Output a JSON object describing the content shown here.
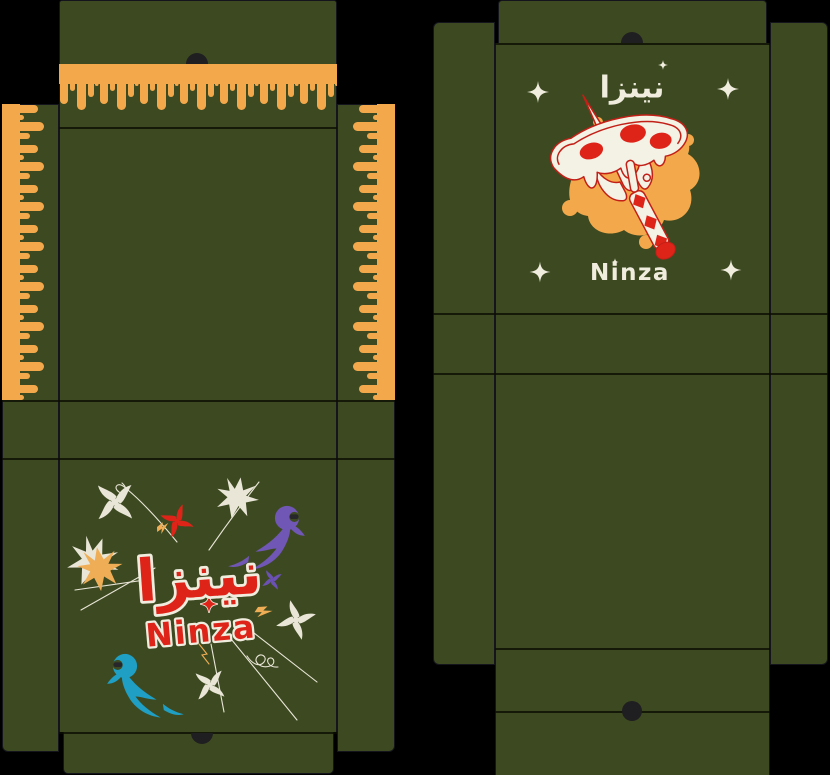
{
  "brand": {
    "arabic": "نينزا",
    "latin": "Ninza"
  },
  "left_dieline": {
    "description": "box base dieline with cheese-drip walls",
    "base_logo": {
      "arabic": "نينزا",
      "latin": "Ninza"
    }
  },
  "right_dieline": {
    "description": "box lid dieline with pizza-sai emblem",
    "lid_logo": {
      "arabic": "نينزا",
      "latin": "Ninza"
    }
  },
  "colors": {
    "bg": "#000000",
    "green": "#3d4a21",
    "orange": "#f3a94b",
    "cream": "#f0edde",
    "cream2": "#f4f1e5",
    "red": "#de2419",
    "red_deep": "#c22017",
    "purple": "#7157b5",
    "purple_sm": "#6b51b4",
    "teal": "#1f9fc4",
    "gold": "#efae55",
    "white_dec": "#e9e6d7",
    "edge": "#14151c",
    "hole": "#1f1e20",
    "eye": "#26262b"
  },
  "icons": {
    "sparkle-icon": "four-point sparkle star",
    "shuriken-icon": "pinwheel throwing star",
    "starburst-icon": "spiky impact burst",
    "ninja-figure": "hooded ninja with motion swoosh",
    "pizza-sai-emblem": "pizza slice pierced by a sai on a sauce splat",
    "drip-edge": "melted cheese drip border",
    "thumb-notch": "die-cut thumb notch",
    "finger-hole": "die-cut finger hole"
  }
}
